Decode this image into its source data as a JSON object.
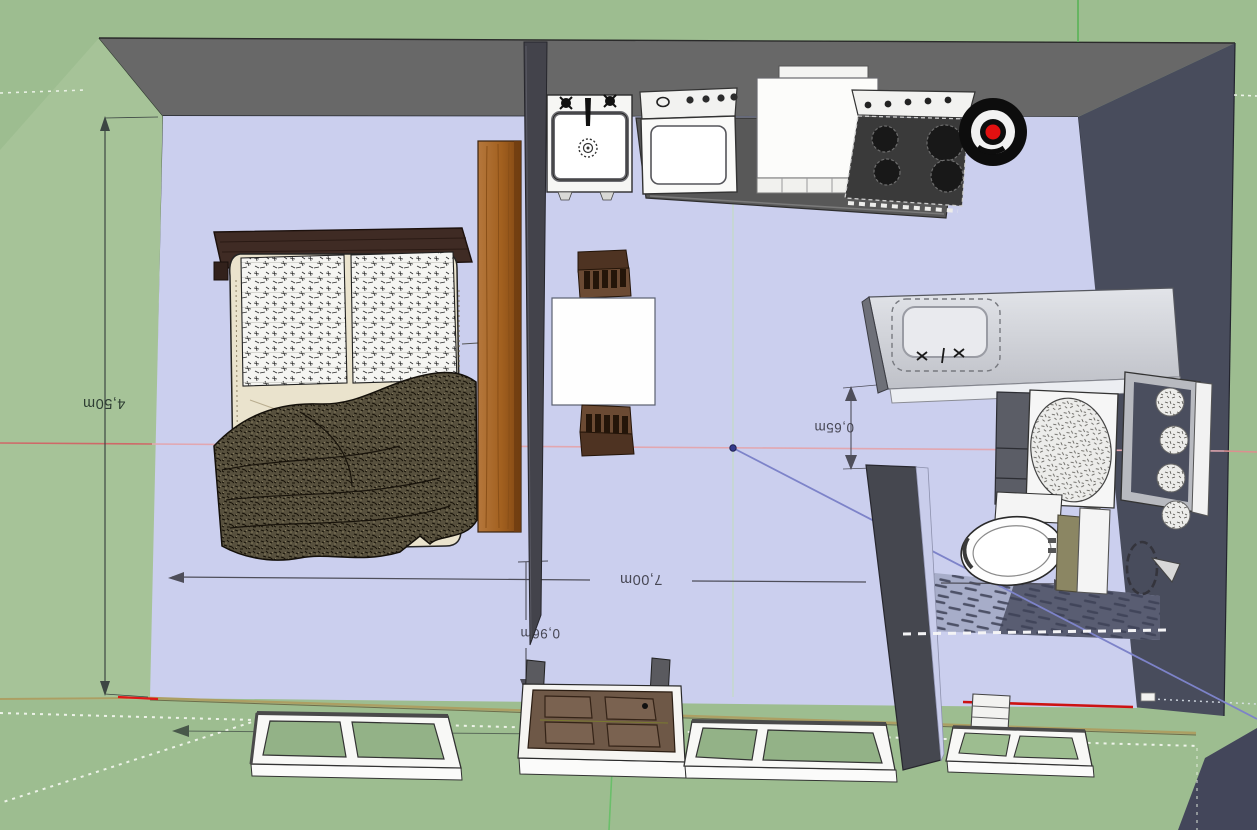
{
  "view": {
    "description": "3D perspective top-down view of a studio apartment model on green ground",
    "background_color": "#9dbd90",
    "floor_color": "#cbcfee",
    "top_wall_color": "#686868",
    "right_wall_color": "#484c5c",
    "wood_color": "#a2601f"
  },
  "dimensions": {
    "room_depth": {
      "label": "4,50m"
    },
    "room_width": {
      "label": "7,00m"
    },
    "doorway": {
      "label": "0,96m"
    },
    "vanity_gap": {
      "label": "0,65m"
    }
  },
  "axes": {
    "red": "#e05858",
    "green": "#6abf6a",
    "blue": "#7d83c9"
  },
  "model_objects": [
    "bed",
    "wardrobe-panel",
    "room-divider",
    "dining-table",
    "dining-chair",
    "kitchen-sink",
    "washer-range",
    "refrigerator",
    "stove-cooktop",
    "kettle",
    "bathroom-counter",
    "bathroom-sink",
    "bathroom-cabinet",
    "laundry-machine",
    "vanity-mirror-lights",
    "toilet",
    "shower-head",
    "shower-floor-tiles",
    "shower-curtain-rail",
    "bathroom-partition",
    "window-frame",
    "panel-door",
    "small-crate"
  ]
}
